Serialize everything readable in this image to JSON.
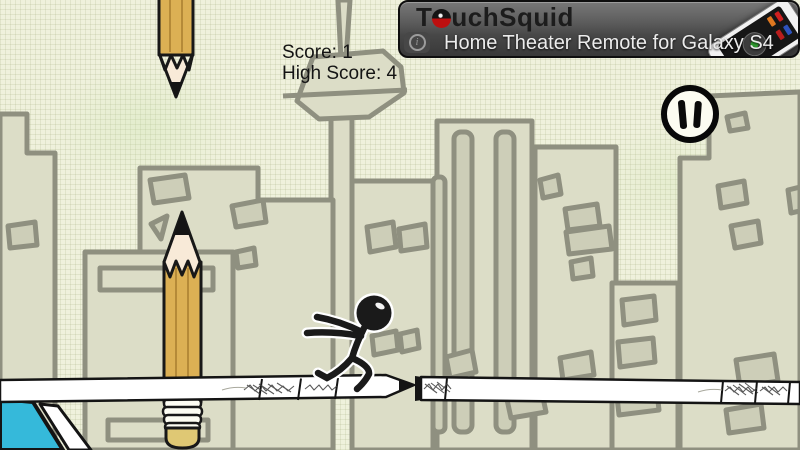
{
  "hud": {
    "score_text": "Score: 1",
    "high_score_text": "High Score: 4",
    "score": 1,
    "high_score": 4
  },
  "pause": {
    "icon": "pause"
  },
  "ad_banner": {
    "brand_prefix": "T",
    "brand_o": "o",
    "brand_suffix": "uchSquid",
    "headline": "Home Theater Remote for Galaxy S4",
    "info_icon": "i",
    "colors": {
      "brand_text": "#1c1c1c",
      "brand_o_red": "#bd0f0f",
      "headline_text": "#ececec",
      "background_top": "#787878",
      "background_bottom": "#393939"
    }
  },
  "scene": {
    "objects": [
      "falling-pencil",
      "standing-pencil",
      "tv-tower",
      "city-buildings",
      "platform-pencil-left",
      "platform-pencil-right",
      "platform-gap",
      "stickman-runner",
      "blue-object"
    ],
    "colors": {
      "paper": "#eff1dc",
      "grid_line": "#d9ddc2",
      "building_fill": "#dcddc7",
      "building_window": "#cdceb8",
      "building_outline": "#8f9080",
      "pencil_body": "#dcb054",
      "pencil_facet_dark": "#b58a38",
      "pencil_wood": "#f8ead8",
      "pencil_graphite": "#141414",
      "eraser": "#dfc874",
      "ferrule": "#fdfdf3",
      "platform_fill": "#ffffff",
      "outline_black": "#141414",
      "blue_object": "#35b9da",
      "stickman": "#1a1a1a"
    }
  }
}
